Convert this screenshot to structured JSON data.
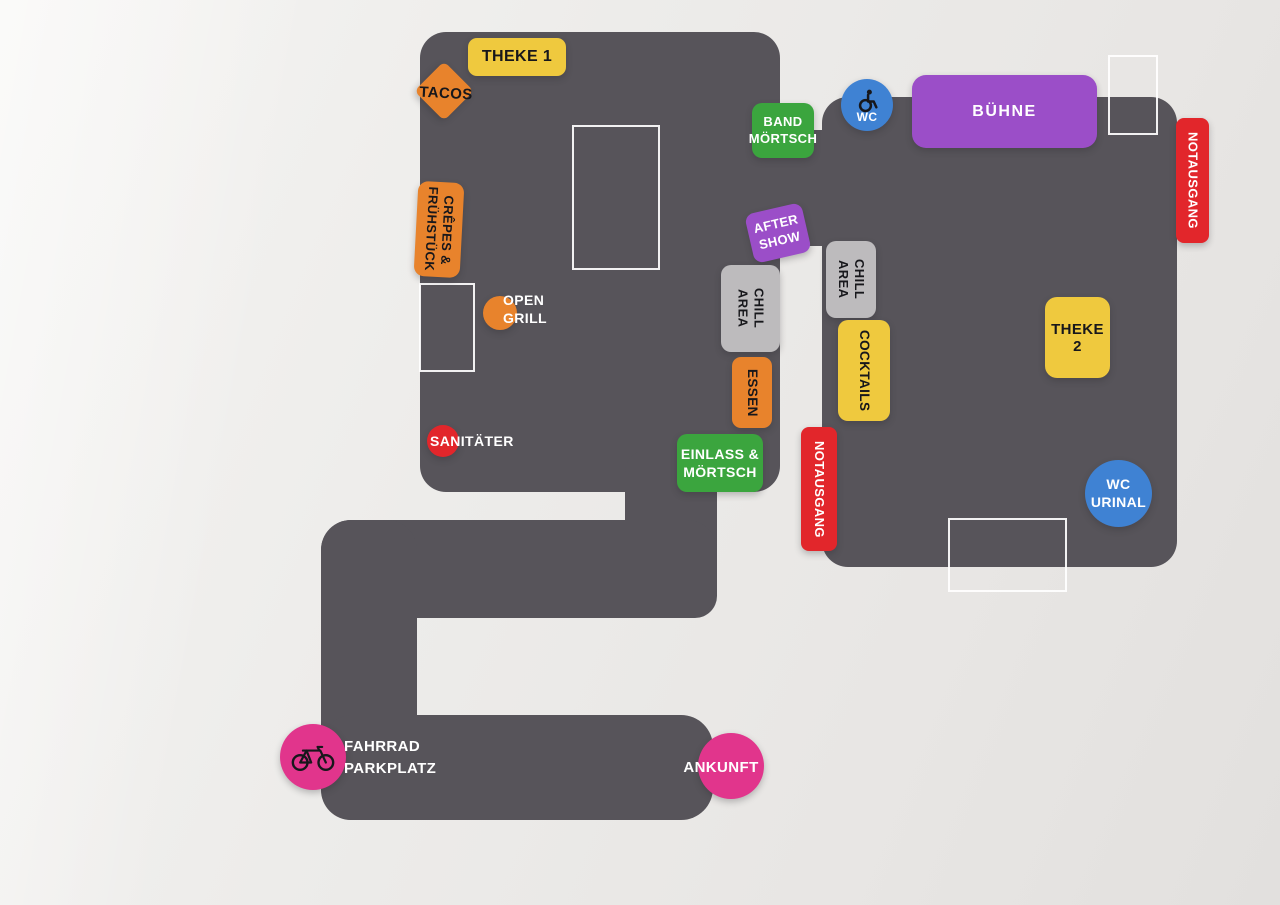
{
  "palette": {
    "background": "#ECEAE8",
    "floor": "#57545A",
    "yellow": "#EFC93E",
    "orange": "#E8832C",
    "green": "#3BA53E",
    "purple": "#9B4EC8",
    "red": "#E2262B",
    "blue": "#3F82D3",
    "pink": "#E1358C",
    "gray": "#BDBBBD",
    "ink": "#17171B",
    "white": "#FFFFFF"
  },
  "labels": {
    "theke1": {
      "text": "THEKE 1"
    },
    "tacos": {
      "text": "TACOS"
    },
    "band_moertsch": {
      "line1": "BAND",
      "line2": "MÖRTSCH"
    },
    "wc_accessible": {
      "text": "WC",
      "icon": "wheelchair-icon"
    },
    "buehne": {
      "text": "BÜHNE"
    },
    "notausgang_stage": {
      "text": "NOTAUSGANG"
    },
    "crepes_fruehstueck": {
      "line1": "CRÊPES &",
      "line2": "FRÜHSTÜCK"
    },
    "open_grill": {
      "line1": "OPEN",
      "line2": "GRILL"
    },
    "after_show": {
      "line1": "AFTER",
      "line2": "SHOW"
    },
    "chill_area_left": {
      "line1": "CHILL",
      "line2": "AREA"
    },
    "chill_area_right": {
      "line1": "CHILL",
      "line2": "AREA"
    },
    "cocktails": {
      "text": "COCKTAILS"
    },
    "essen": {
      "text": "ESSEN"
    },
    "theke2": {
      "text": "THEKE 2"
    },
    "sanitaeter": {
      "text": "SANITÄTER"
    },
    "einlass_moertsch": {
      "line1": "EINLASS &",
      "line2": "MÖRTSCH"
    },
    "notausgang_mid": {
      "text": "NOTAUSGANG"
    },
    "wc_urinal": {
      "line1": "WC",
      "line2": "URINAL"
    },
    "fahrrad_parkplatz": {
      "line1": "FAHRRAD",
      "line2": "PARKPLATZ",
      "icon": "bicycle-icon"
    },
    "ankunft": {
      "text": "ANKUNFT"
    }
  }
}
